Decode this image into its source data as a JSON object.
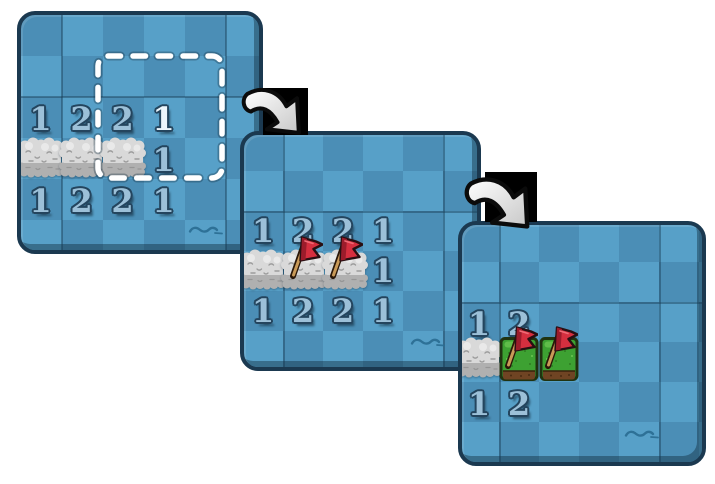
{
  "figure": {
    "type": "minesweeper-tutorial-sequence",
    "steps_shown": 3
  },
  "colors": {
    "board_dark": "#4b8eb6",
    "board_light": "#57a0c8",
    "panel_border": "#1b3950",
    "grid_line": "#1a374f",
    "number_fill": "#9cc0d8",
    "number_fill_new": "#ecf5fb",
    "number_outline": "#24455e",
    "fog_light": "#d9d9d9",
    "fog_shadow": "#b0b0b0",
    "flag_red": "#d62f3f",
    "flag_pole": "#c99a58",
    "grass_green": "#3da132",
    "soil_brown": "#6f4423",
    "highlight_dash": "#ffffff",
    "wave": "#2a6d92",
    "arrow_fill": "#f5f5f5",
    "arrow_backdrop": "#000000"
  },
  "icons": {
    "cloud": "fog-tile",
    "flag": "red-flag-marker",
    "grass": "revealed-mine-tile",
    "arrow": "next-step-arrow",
    "wave": "water-ripple",
    "highlight": "dashed-selection-box"
  },
  "panels": [
    {
      "step": 1,
      "fog_tiles": 3,
      "flags": 0,
      "has_highlight": true,
      "numbers": [
        {
          "value": "1"
        },
        {
          "value": "2"
        },
        {
          "value": "2"
        },
        {
          "value": "1",
          "state": "just-revealed"
        },
        {
          "value": "1"
        },
        {
          "value": "1"
        },
        {
          "value": "2"
        },
        {
          "value": "2"
        },
        {
          "value": "1"
        }
      ]
    },
    {
      "step": 2,
      "fog_tiles": 3,
      "flags": 2,
      "numbers": [
        {
          "value": "1"
        },
        {
          "value": "2"
        },
        {
          "value": "2"
        },
        {
          "value": "1"
        },
        {
          "value": "1"
        },
        {
          "value": "1"
        },
        {
          "value": "2"
        },
        {
          "value": "2"
        },
        {
          "value": "1"
        }
      ]
    },
    {
      "step": 3,
      "fog_tiles": 1,
      "flags": 2,
      "mine_tiles": 2,
      "numbers": [
        {
          "value": "1"
        },
        {
          "value": "2"
        },
        {
          "value": "1"
        },
        {
          "value": "2"
        }
      ]
    }
  ]
}
